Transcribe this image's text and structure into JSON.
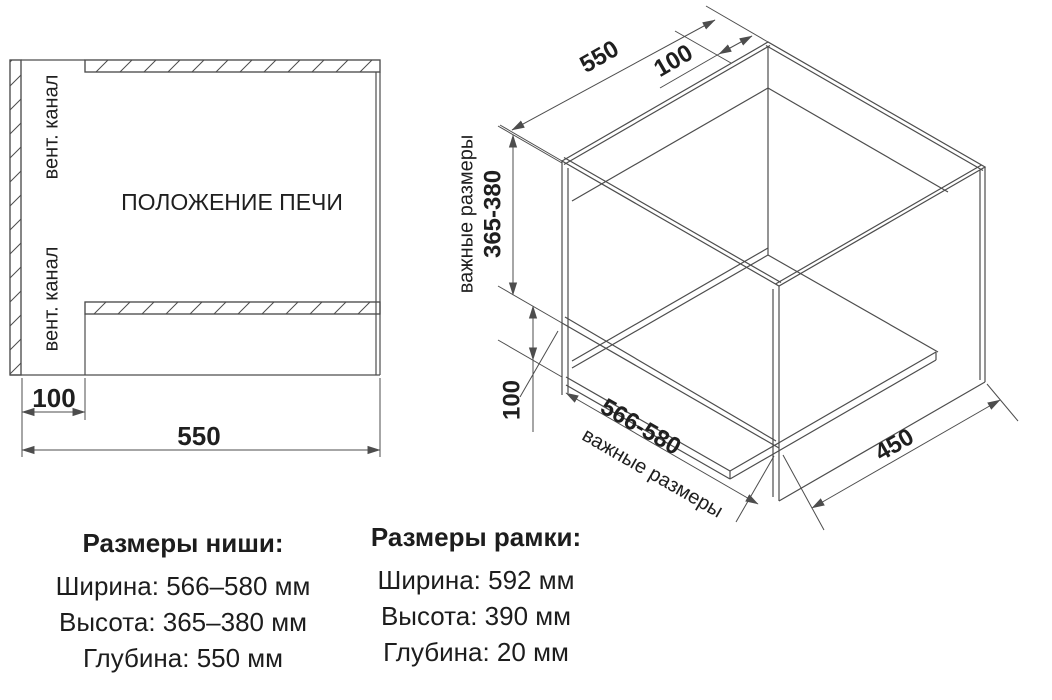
{
  "front_view": {
    "vent_channel_top": "вент. канал",
    "vent_channel_bottom": "вент. канал",
    "oven_position": "ПОЛОЖЕНИЕ ПЕЧИ",
    "dim_gap": "100",
    "dim_depth": "550"
  },
  "iso_view": {
    "dim_depth": "550",
    "dim_back_vent": "100",
    "label_important_left": "важные размеры",
    "dim_height": "365-380",
    "dim_bottom_vent": "100",
    "dim_width": "566-580",
    "label_important_bottom": "важные размеры",
    "dim_shelf_depth": "450"
  },
  "specs": {
    "niche": {
      "title": "Размеры ниши:",
      "rows": [
        "Ширина: 566–580 мм",
        "Высота: 365–380 мм",
        "Глубина: 550 мм"
      ]
    },
    "frame": {
      "title": "Размеры рамки:",
      "rows": [
        "Ширина: 592 мм",
        "Высота: 390 мм",
        "Глубина: 20 мм"
      ]
    }
  },
  "colors": {
    "line": "#4d4d4d",
    "text": "#1f1f1f",
    "background": "#ffffff"
  }
}
